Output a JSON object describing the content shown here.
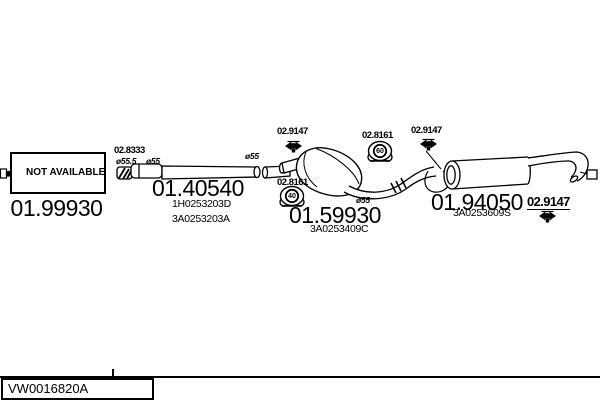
{
  "diagram": {
    "front_section": {
      "status": "NOT AVAILABLE",
      "part_number": "01.99930"
    },
    "coupler": {
      "part_number": "02.8333",
      "dia_in": "ø55.5",
      "dia_out": "ø55"
    },
    "front_pipe": {
      "part_number": "01.40540",
      "oem_ref_1": "1H0253203D",
      "oem_ref_2": "3A0253203A",
      "dia": "ø55"
    },
    "mid_muffler": {
      "part_number": "01.59930",
      "oem_ref": "3A0253409C",
      "dia": "ø55"
    },
    "rear_muffler": {
      "part_number": "01.94050",
      "oem_ref": "3A0253609S"
    },
    "clamp": {
      "part_number": "02.9147"
    },
    "hanger_front": {
      "part_number": "02.8161",
      "size": "40"
    },
    "hanger_rear": {
      "part_number": "02.8161",
      "size": "60"
    }
  },
  "footer": {
    "drawing_code": "VW0016820A"
  }
}
